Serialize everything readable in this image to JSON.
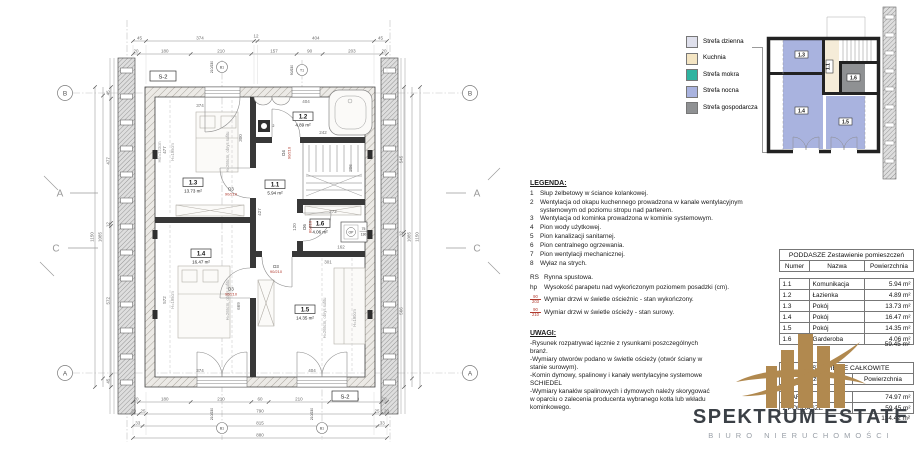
{
  "plan": {
    "accent_red": "#b03a2e",
    "s2": "S-2",
    "grid_b": "B",
    "grid_a": "A",
    "sec_a": "A",
    "sec_c": "C",
    "b1": "B1",
    "t1": "T1",
    "b1_dim": "210/230",
    "t1_dim": "90/230",
    "dims": {
      "top1": [
        "45",
        "374",
        "12",
        "404",
        "45"
      ],
      "top2": [
        "20",
        "180",
        "210",
        "157",
        "90",
        "203",
        "20"
      ],
      "bot1": [
        "20",
        "180",
        "210",
        "60",
        "210",
        "180",
        "20"
      ],
      "bot2": [
        "20",
        "25",
        "790",
        "25",
        "20"
      ],
      "bot3": [
        "33",
        "815",
        "33"
      ],
      "bot4": "880",
      "left": [
        "45",
        "477",
        "12",
        "572",
        "45"
      ],
      "left_t1": "1085",
      "left_t2": "1150",
      "right": [
        "545",
        "12",
        "566"
      ],
      "right_t1": "1085",
      "right_t2": "1150"
    },
    "rooms": [
      {
        "num": "1.3",
        "area": "13.73 m²"
      },
      {
        "num": "1.4",
        "area": "16.47 m²"
      },
      {
        "num": "1.1",
        "area": "5.94 m²"
      },
      {
        "num": "1.2",
        "area": "4.89 m²"
      },
      {
        "num": "1.6",
        "area": "4.06 m²"
      },
      {
        "num": "1.5",
        "area": "14.35 m²"
      }
    ],
    "inner": {
      "a": "374",
      "b": "300",
      "c": "404",
      "d": "242",
      "e": "427",
      "f": "272",
      "g": "301",
      "h": "374",
      "i": "404",
      "j": "572",
      "k": "669",
      "l": "477",
      "m": "206",
      "n": "120",
      "o": "162",
      "ref2": "2"
    },
    "heights": {
      "h1": "Hśr=123cm",
      "h2": "H=195cm",
      "h3": "H=265cm, obrys sufitu",
      "h4": "H=190cm"
    },
    "doors": {
      "d3": "D3",
      "d4": "D4",
      "d6": "D6",
      "dim90": "90/210",
      "dim80": "80/210",
      "op": "OP",
      "op_num": "75",
      "op_den": "130"
    }
  },
  "zones": {
    "items": [
      {
        "label": "Strefa dzienna",
        "color": "#dfe0ec"
      },
      {
        "label": "Kuchnia",
        "color": "#f4e5c3"
      },
      {
        "label": "Strefa mokra",
        "color": "#2fb3a0"
      },
      {
        "label": "Strefa nocna",
        "color": "#a9b3df"
      },
      {
        "label": "Strefa gospodarcza",
        "color": "#8f9193"
      }
    ]
  },
  "mini": {
    "labels": {
      "r13": "1.3",
      "r14": "1.4",
      "r15": "1.5",
      "r11": "1.1",
      "r16": "1.6"
    },
    "colors": {
      "night": "#a9b3df",
      "day": "#f5ecd8",
      "utility": "#8f9193"
    }
  },
  "legend": {
    "title": "LEGENDA:",
    "items": [
      {
        "n": "1",
        "t": "Słup żelbetowy w ściance kolankowej."
      },
      {
        "n": "2",
        "t": "Wentylacja od okapu kuchennego prowadzona w kanale wentylacyjnym systemowym od poziomu stropu nad parterem."
      },
      {
        "n": "3",
        "t": "Wentylacja od kominka prowadzona w kominie systemowym."
      },
      {
        "n": "4",
        "t": "Pion wody użytkowej."
      },
      {
        "n": "5",
        "t": "Pion kanalizacji sanitarnej."
      },
      {
        "n": "6",
        "t": "Pion centralnego ogrzewania."
      },
      {
        "n": "7",
        "t": "Pion wentylacji mechanicznej."
      },
      {
        "n": "8",
        "t": "Wyłaz na strych."
      }
    ],
    "rs_key": "RS",
    "rs_text": "Rynna spustowa.",
    "hp_key": "hp",
    "hp_text": "Wysokość parapetu nad wykończonym poziomem posadzki (cm).",
    "sym1_num": "90",
    "sym1_den": "203",
    "sym1_text": "Wymiar drzwi w świetle ościeżnic - stan wykończony.",
    "sym2_num": "90",
    "sym2_den": "210",
    "sym2_text": "Wymiar drzwi w świetle ościeży - stan surowy."
  },
  "notes": {
    "title": "UWAGI:",
    "items": [
      "-Rysunek rozpatrywać łącznie z rysunkami poszczególnych branż.",
      "-Wymiary otworów podano w świetle ościeży (otwór ściany w stanie surowym).",
      "-Komin dymowy, spalinowy i kanały wentylacyjne systemowe SCHIEDEL",
      "-Wymiary kanałów spalinowych i dymowych należy skorygować w oparciu o zalecenia producenta wybranego kotła lub wkładu kominkowego."
    ]
  },
  "rooms_table": {
    "title": "PODDASZE Zestawienie pomieszczeń",
    "headers": [
      "Numer",
      "Nazwa",
      "Powierzchnia"
    ],
    "rows": [
      {
        "num": "1.1",
        "name": "Komunikacja",
        "area": "5.94 m²"
      },
      {
        "num": "1.2",
        "name": "Łazienka",
        "area": "4.89 m²"
      },
      {
        "num": "1.3",
        "name": "Pokój",
        "area": "13.73 m²"
      },
      {
        "num": "1.4",
        "name": "Pokój",
        "area": "16.47 m²"
      },
      {
        "num": "1.5",
        "name": "Pokój",
        "area": "14.35 m²"
      },
      {
        "num": "1.6",
        "name": "Garderoba",
        "area": "4.06 m²"
      }
    ],
    "total": "59.45 m²"
  },
  "totals_table": {
    "title": "ZESTAWIENIE CAŁKOWITE",
    "headers": [
      "Poziom",
      "Powierzchnia"
    ],
    "rows": [
      {
        "name": "1 PARTER",
        "area": "74.97 m²"
      },
      {
        "name": "2 PODDASZE",
        "area": "59.45 m²"
      }
    ],
    "total": "134.42 m²"
  },
  "logo": {
    "name": "SPEKTRUM ESTATE",
    "subtitle": "BIURO NIERUCHOMOŚCI",
    "color": "#b1894f"
  }
}
